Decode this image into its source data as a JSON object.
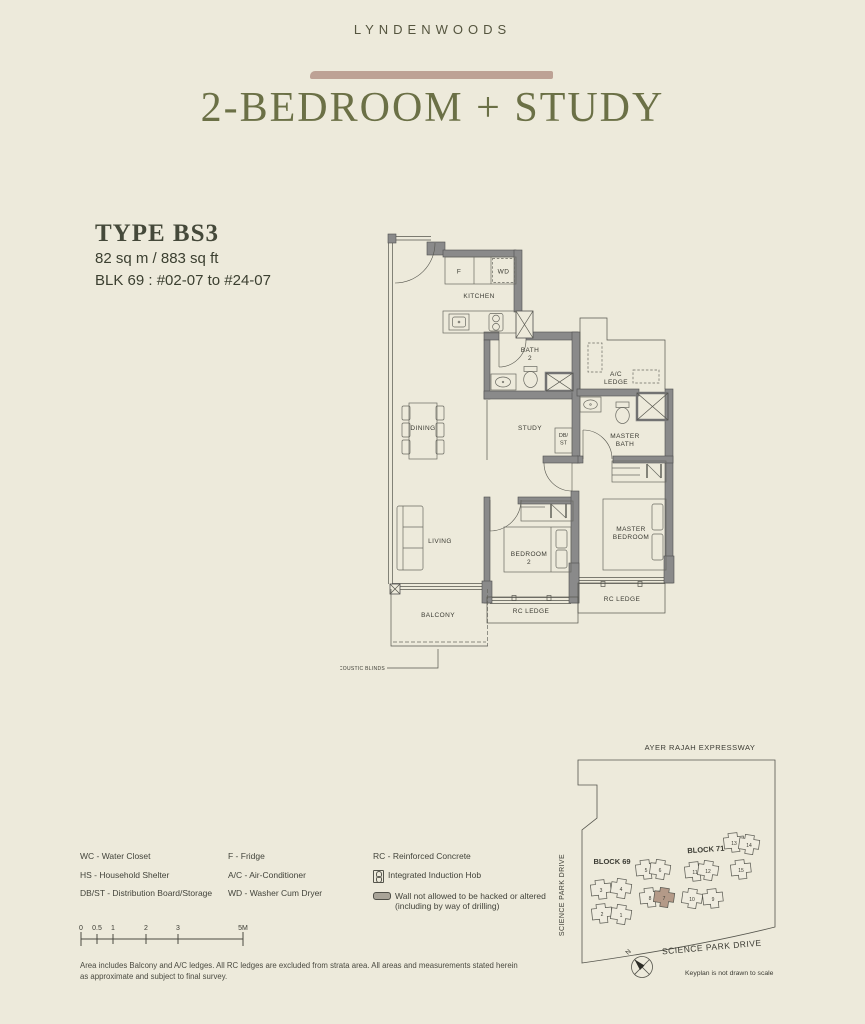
{
  "header": {
    "brand": "LYNDENWOODS",
    "title": "2-BEDROOM + STUDY"
  },
  "unit_info": {
    "type": "TYPE BS3",
    "area": "82 sq m / 883 sq ft",
    "block": "BLK 69 : #02-07 to #24-07"
  },
  "floorplan": {
    "labels": {
      "kitchen": "KITCHEN",
      "fridge": "F",
      "washer": "WD",
      "bath2_1": "BATH",
      "bath2_2": "2",
      "ac_1": "A/C",
      "ac_2": "LEDGE",
      "dining": "DINING",
      "study": "STUDY",
      "dbst_1": "DB/",
      "dbst_2": "ST",
      "mbath_1": "MASTER",
      "mbath_2": "BATH",
      "living": "LIVING",
      "bed2_1": "BEDROOM",
      "bed2_2": "2",
      "mbed_1": "MASTER",
      "mbed_2": "BEDROOM",
      "balcony": "BALCONY",
      "rcledge1": "RC LEDGE",
      "rcledge2": "RC LEDGE",
      "acoustic": "ACOUSTIC BLINDS"
    }
  },
  "legend": {
    "col1": [
      "WC - Water Closet",
      "HS - Household Shelter",
      "DB/ST - Distribution Board/Storage"
    ],
    "col2": [
      "F - Fridge",
      "A/C - Air-Conditioner",
      "WD - Washer Cum Dryer"
    ],
    "col3_rc": "RC - Reinforced Concrete",
    "col3_hob": "Integrated Induction Hob",
    "col3_wall_1": "Wall not allowed to be hacked or altered",
    "col3_wall_2": "(including by way of drilling)"
  },
  "scale_bar": {
    "labels": [
      "0",
      "0.5",
      "1",
      "2",
      "3",
      "5M"
    ]
  },
  "disclaimer": "Area includes Balcony and A/C ledges. All RC ledges are excluded from strata area. All areas and measurements stated herein as approximate and subject to final survey.",
  "keyplan": {
    "road_top": "AYER RAJAH EXPRESSWAY",
    "road_left": "SCIENCE PARK DRIVE",
    "road_bottom": "SCIENCE PARK DRIVE",
    "block69": "BLOCK 69",
    "block71": "BLOCK 71",
    "north_label": "N",
    "note": "Keyplan is not drawn to scale",
    "units": [
      {
        "n": "3",
        "x": 61,
        "y": 155,
        "hl": false
      },
      {
        "n": "4",
        "x": 81,
        "y": 154,
        "hl": false
      },
      {
        "n": "5",
        "x": 106,
        "y": 135,
        "hl": false
      },
      {
        "n": "6",
        "x": 120,
        "y": 135,
        "hl": false
      },
      {
        "n": "8",
        "x": 110,
        "y": 163,
        "hl": false
      },
      {
        "n": "7",
        "x": 124,
        "y": 163,
        "hl": true
      },
      {
        "n": "2",
        "x": 62,
        "y": 179,
        "hl": false
      },
      {
        "n": "1",
        "x": 81,
        "y": 180,
        "hl": false
      },
      {
        "n": "13",
        "x": 194,
        "y": 108,
        "hl": false
      },
      {
        "n": "14",
        "x": 209,
        "y": 110,
        "hl": false
      },
      {
        "n": "11",
        "x": 155,
        "y": 137,
        "hl": false
      },
      {
        "n": "12",
        "x": 168,
        "y": 136,
        "hl": false
      },
      {
        "n": "15",
        "x": 201,
        "y": 135,
        "hl": false
      },
      {
        "n": "10",
        "x": 152,
        "y": 164,
        "hl": false
      },
      {
        "n": "9",
        "x": 173,
        "y": 164,
        "hl": false
      }
    ]
  },
  "colors": {
    "background": "#edeadb",
    "accent_bar": "#bda295",
    "title_green": "#6b7046",
    "wall_gray": "#8a8a8a",
    "unit_highlight": "#b49a88"
  }
}
